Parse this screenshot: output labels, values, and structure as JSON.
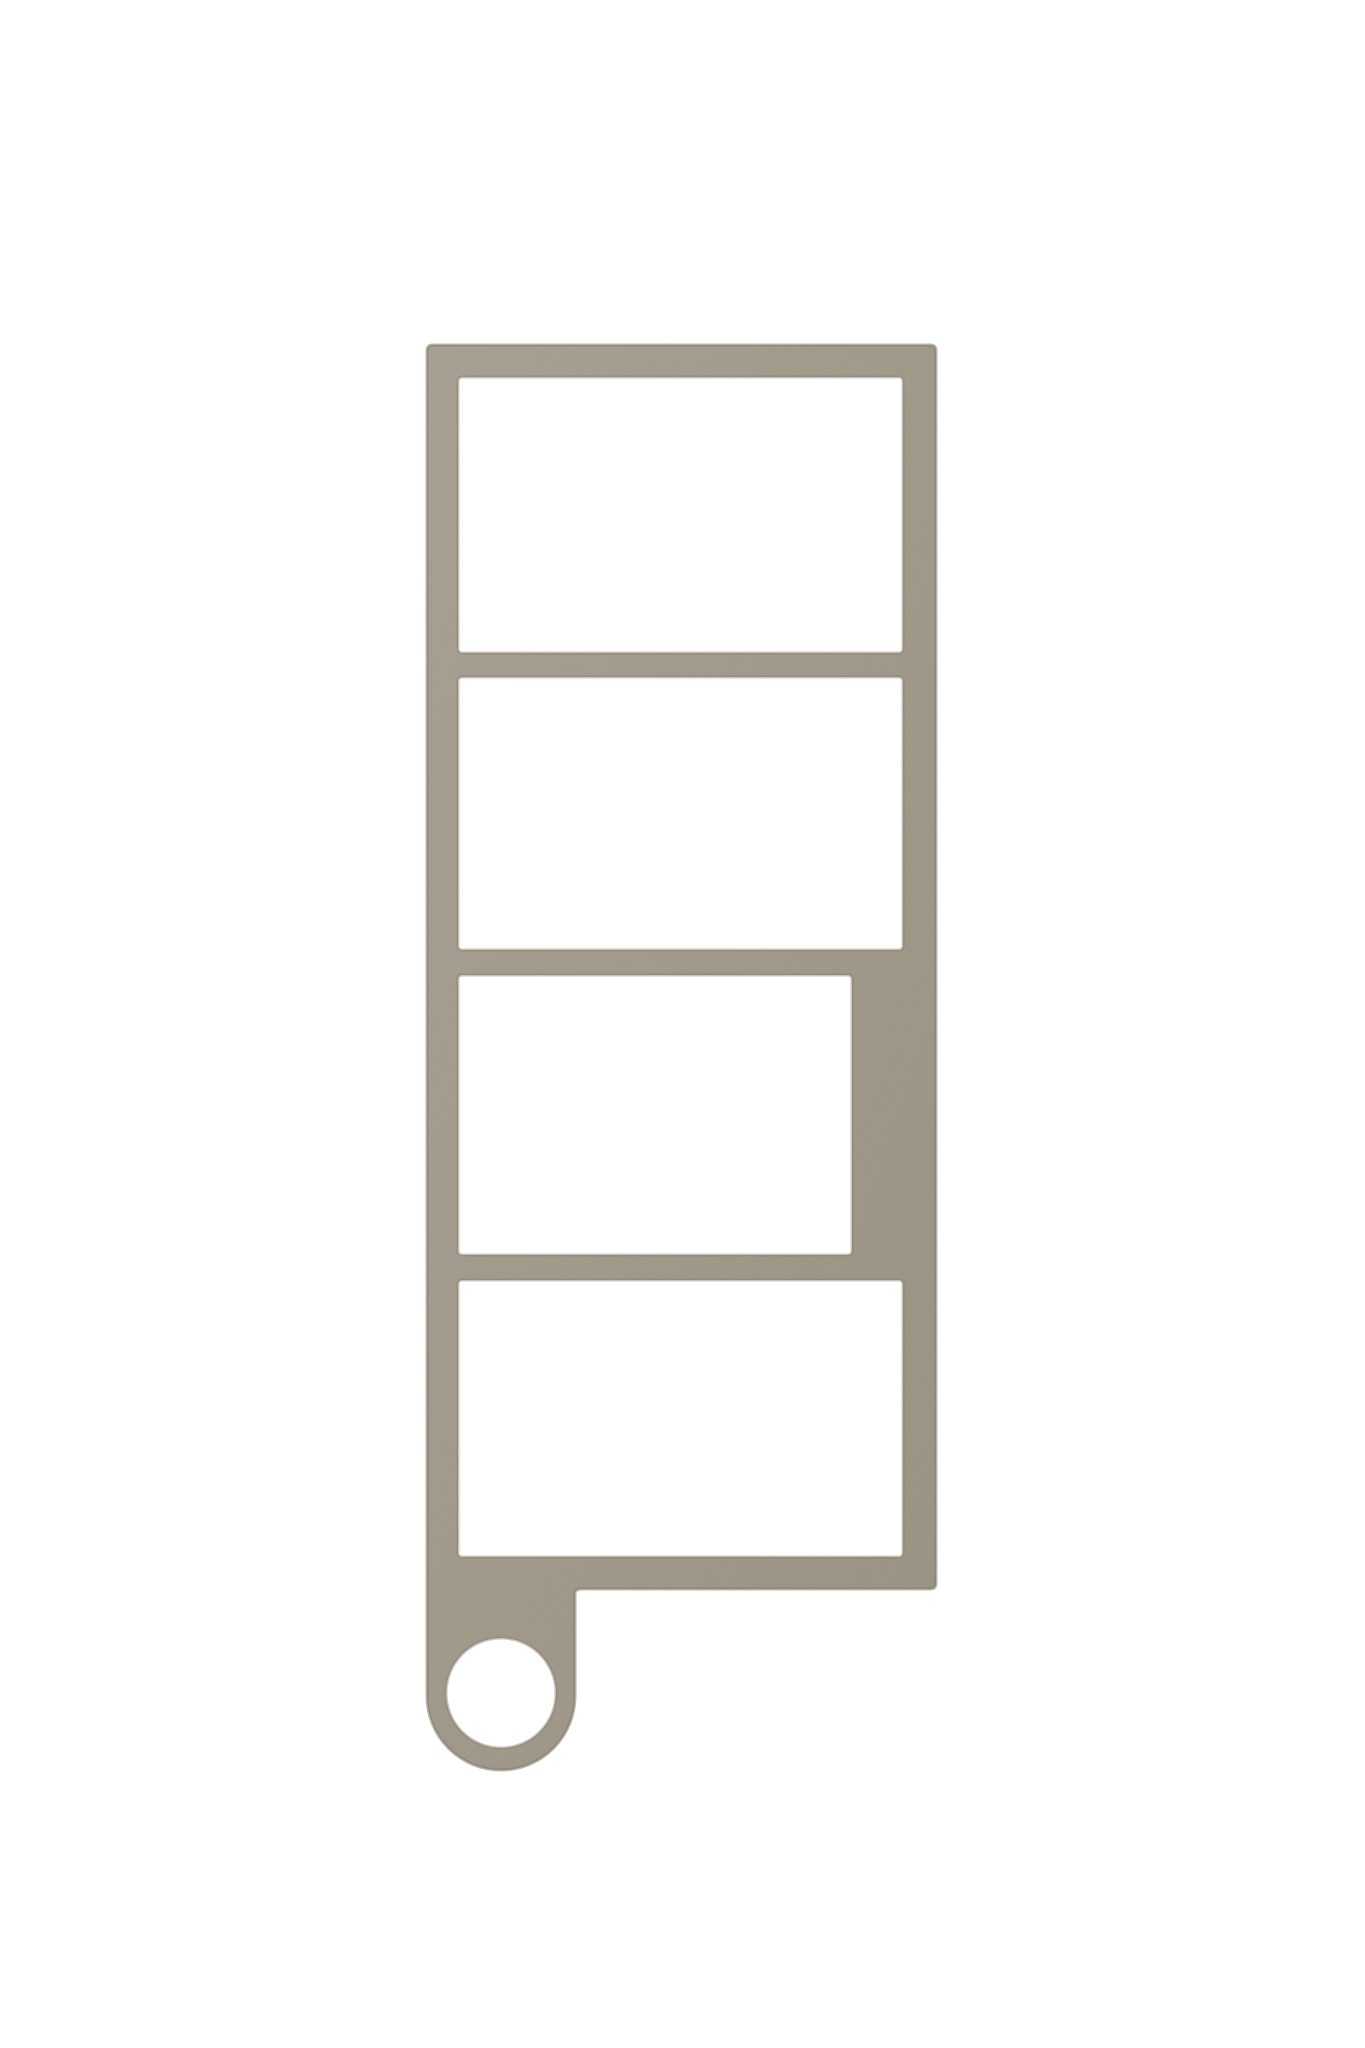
{
  "scene": {
    "background_color": "#ffffff",
    "object": {
      "name": "four-window frame keychain render",
      "body_color_light": "#aca496",
      "body_color_dark": "#9e9686",
      "edge_shade_color": "#857d6d",
      "opening_fill_color": "#ffffff",
      "openings_count": 4
    }
  }
}
